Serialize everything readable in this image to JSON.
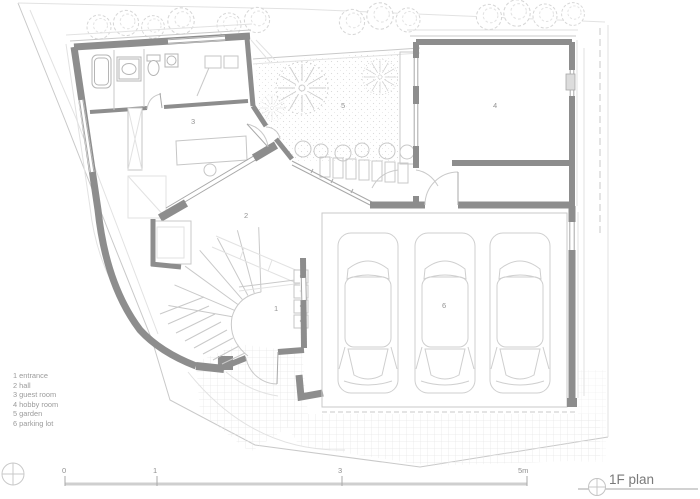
{
  "drawing": {
    "title": "1F plan",
    "legend": [
      "1 entrance",
      "2 hall",
      "3 guest room",
      "4 hobby room",
      "5 garden",
      "6 parking lot"
    ],
    "room_labels": {
      "entrance": "1",
      "hall": "2",
      "guest_room": "3",
      "hobby_room": "4",
      "garden": "5",
      "parking_lot": "6"
    },
    "scale_bar": {
      "ticks": [
        "0",
        "1",
        "3",
        "5m"
      ]
    },
    "colors": {
      "wall": "#8d8d8d",
      "light_line": "#c9c9c9",
      "text": "#949494"
    }
  }
}
